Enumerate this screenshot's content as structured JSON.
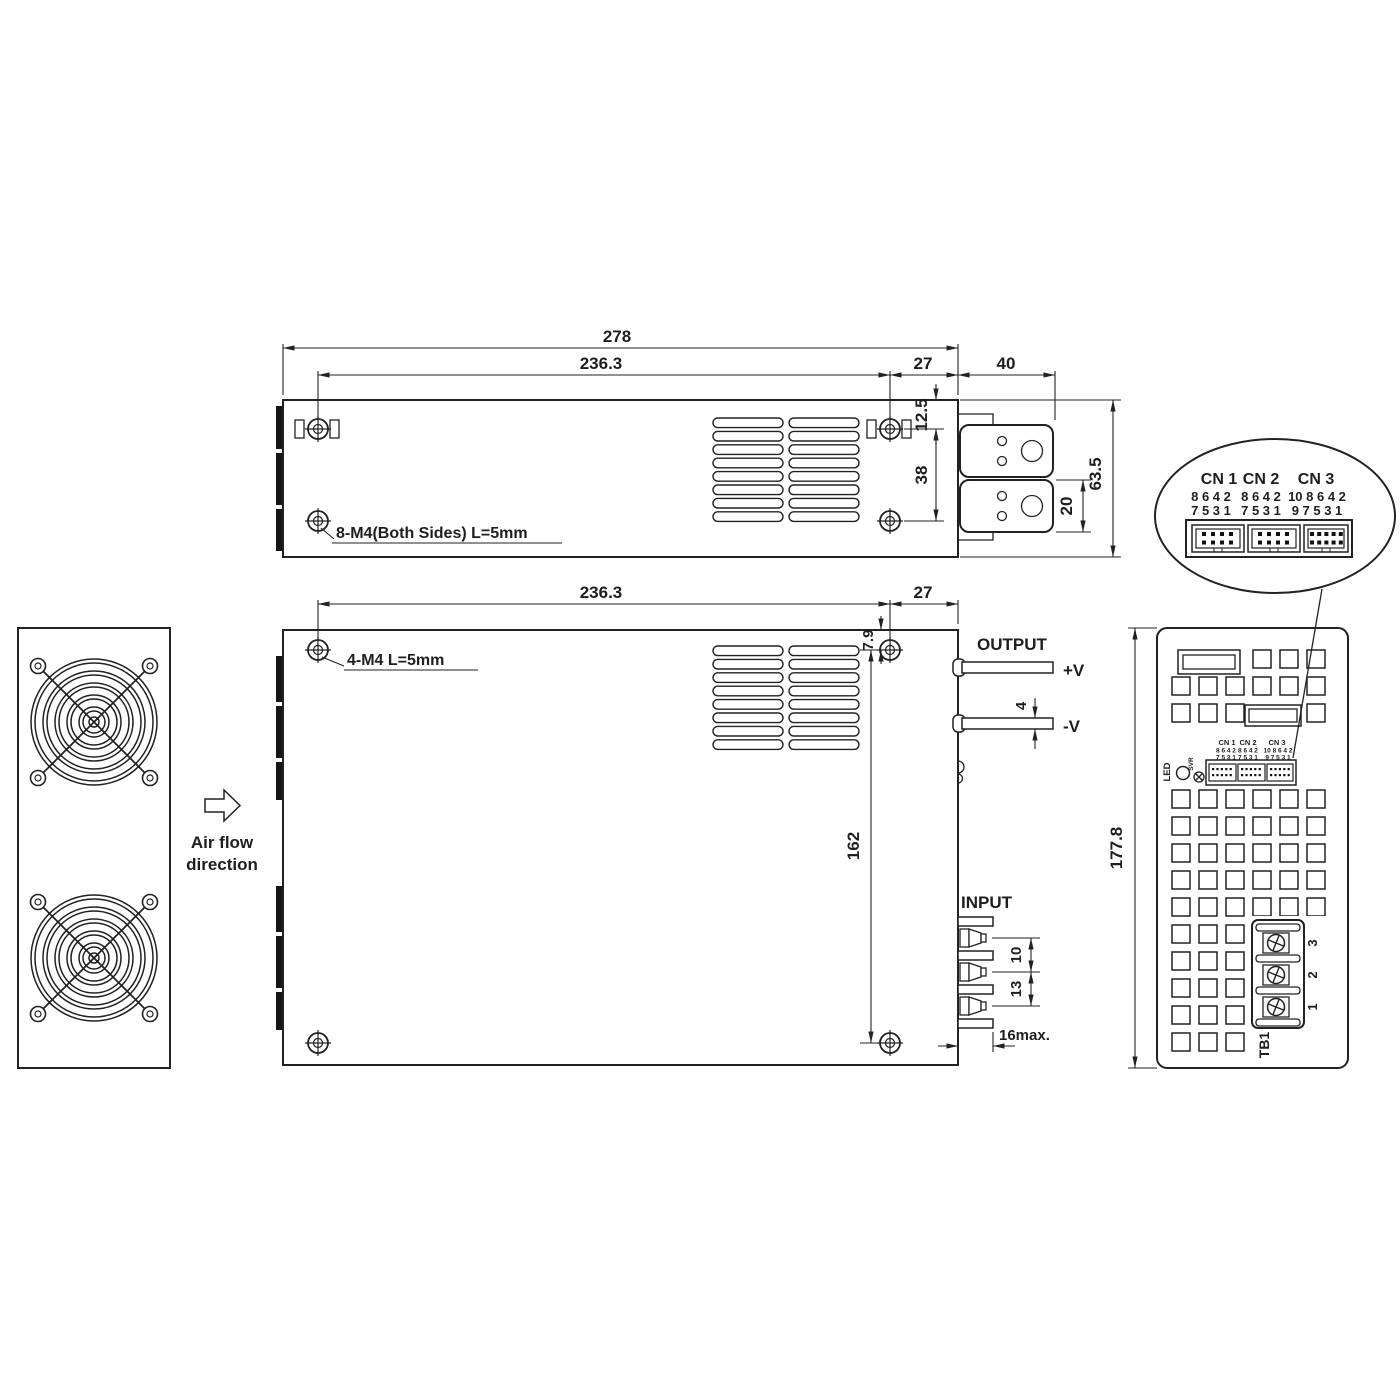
{
  "top_view": {
    "dim_overall_length": "278",
    "dim_screw_span": "236.3",
    "dim_screw_to_edge": "27",
    "dim_terminal_length": "40",
    "dim_top_to_screw": "12.5",
    "dim_screw_spacing": "38",
    "dim_busbar_height": "20",
    "dim_body_depth": "63.5",
    "mounting_note": "8-M4(Both Sides) L=5mm"
  },
  "front_view": {
    "dim_screw_span": "236.3",
    "dim_screw_to_edge": "27",
    "dim_top_to_screw": "7.9",
    "dim_busbar_thickness": "4",
    "dim_screw_vertical_span": "162",
    "dim_input_pitch_upper": "10",
    "dim_input_pitch_lower": "13",
    "dim_terminal_protrusion": "16max.",
    "mounting_note": "4-M4 L=5mm",
    "output_label": "OUTPUT",
    "output_positive": "+V",
    "output_negative": "-V",
    "input_label": "INPUT"
  },
  "side_view": {
    "airflow_line1": "Air flow",
    "airflow_line2": "direction"
  },
  "rear_view": {
    "dim_height": "177.8",
    "led_label": "LED",
    "pot_label": "SVR",
    "tb1_label": "TB1",
    "terminal_3": "3",
    "terminal_2": "2",
    "terminal_1": "1"
  },
  "connectors": {
    "cn1_label": "CN 1",
    "cn2_label": "CN 2",
    "cn3_label": "CN 3",
    "cn1_pins_top": "8 6 4 2",
    "cn1_pins_bottom": "7 5 3 1",
    "cn2_pins_top": "8 6 4 2",
    "cn2_pins_bottom": "7 5 3 1",
    "cn3_pins_top": "10 8 6 4 2",
    "cn3_pins_bottom": "9 7 5 3 1"
  }
}
